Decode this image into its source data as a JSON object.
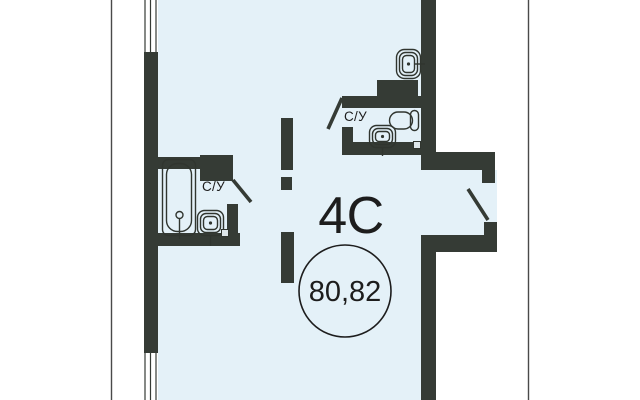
{
  "plan": {
    "type_label": "4С",
    "area_value": "80,82",
    "wc_label_upper": "С/У",
    "wc_label_left": "С/У"
  },
  "colors": {
    "wall": "#353b35",
    "floor": "#e4f1f8",
    "outline": "#30352f",
    "text": "#1d1d1d",
    "divider": "#4a4a4a",
    "background": "#ffffff"
  }
}
